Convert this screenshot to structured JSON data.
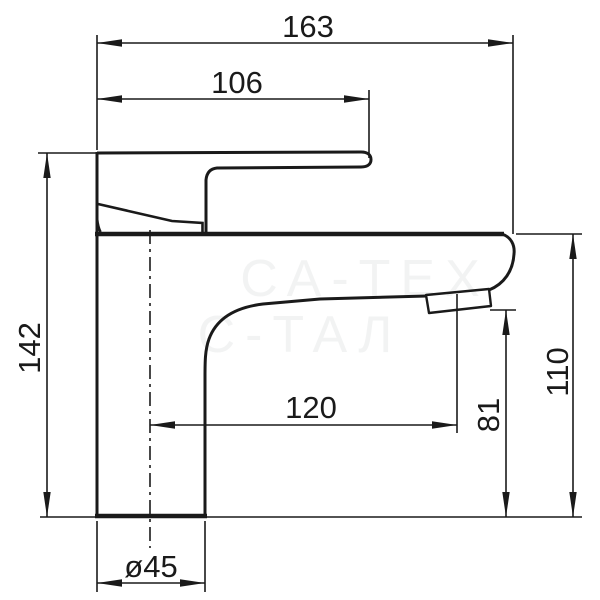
{
  "drawing": {
    "type": "technical-dimension-drawing",
    "subject": "single-lever basin mixer faucet, side view",
    "colors": {
      "line": "#1a1a1a",
      "background": "#ffffff"
    },
    "dimensions": {
      "overall_length": "163",
      "handle_length": "106",
      "overall_height": "142",
      "spout_reach": "120",
      "aerator_height": "81",
      "body_height": "110",
      "base_diameter": "ø45"
    },
    "watermark": {
      "line1": "СА-ТЕХ",
      "line2": "С-ТАЛ"
    }
  }
}
